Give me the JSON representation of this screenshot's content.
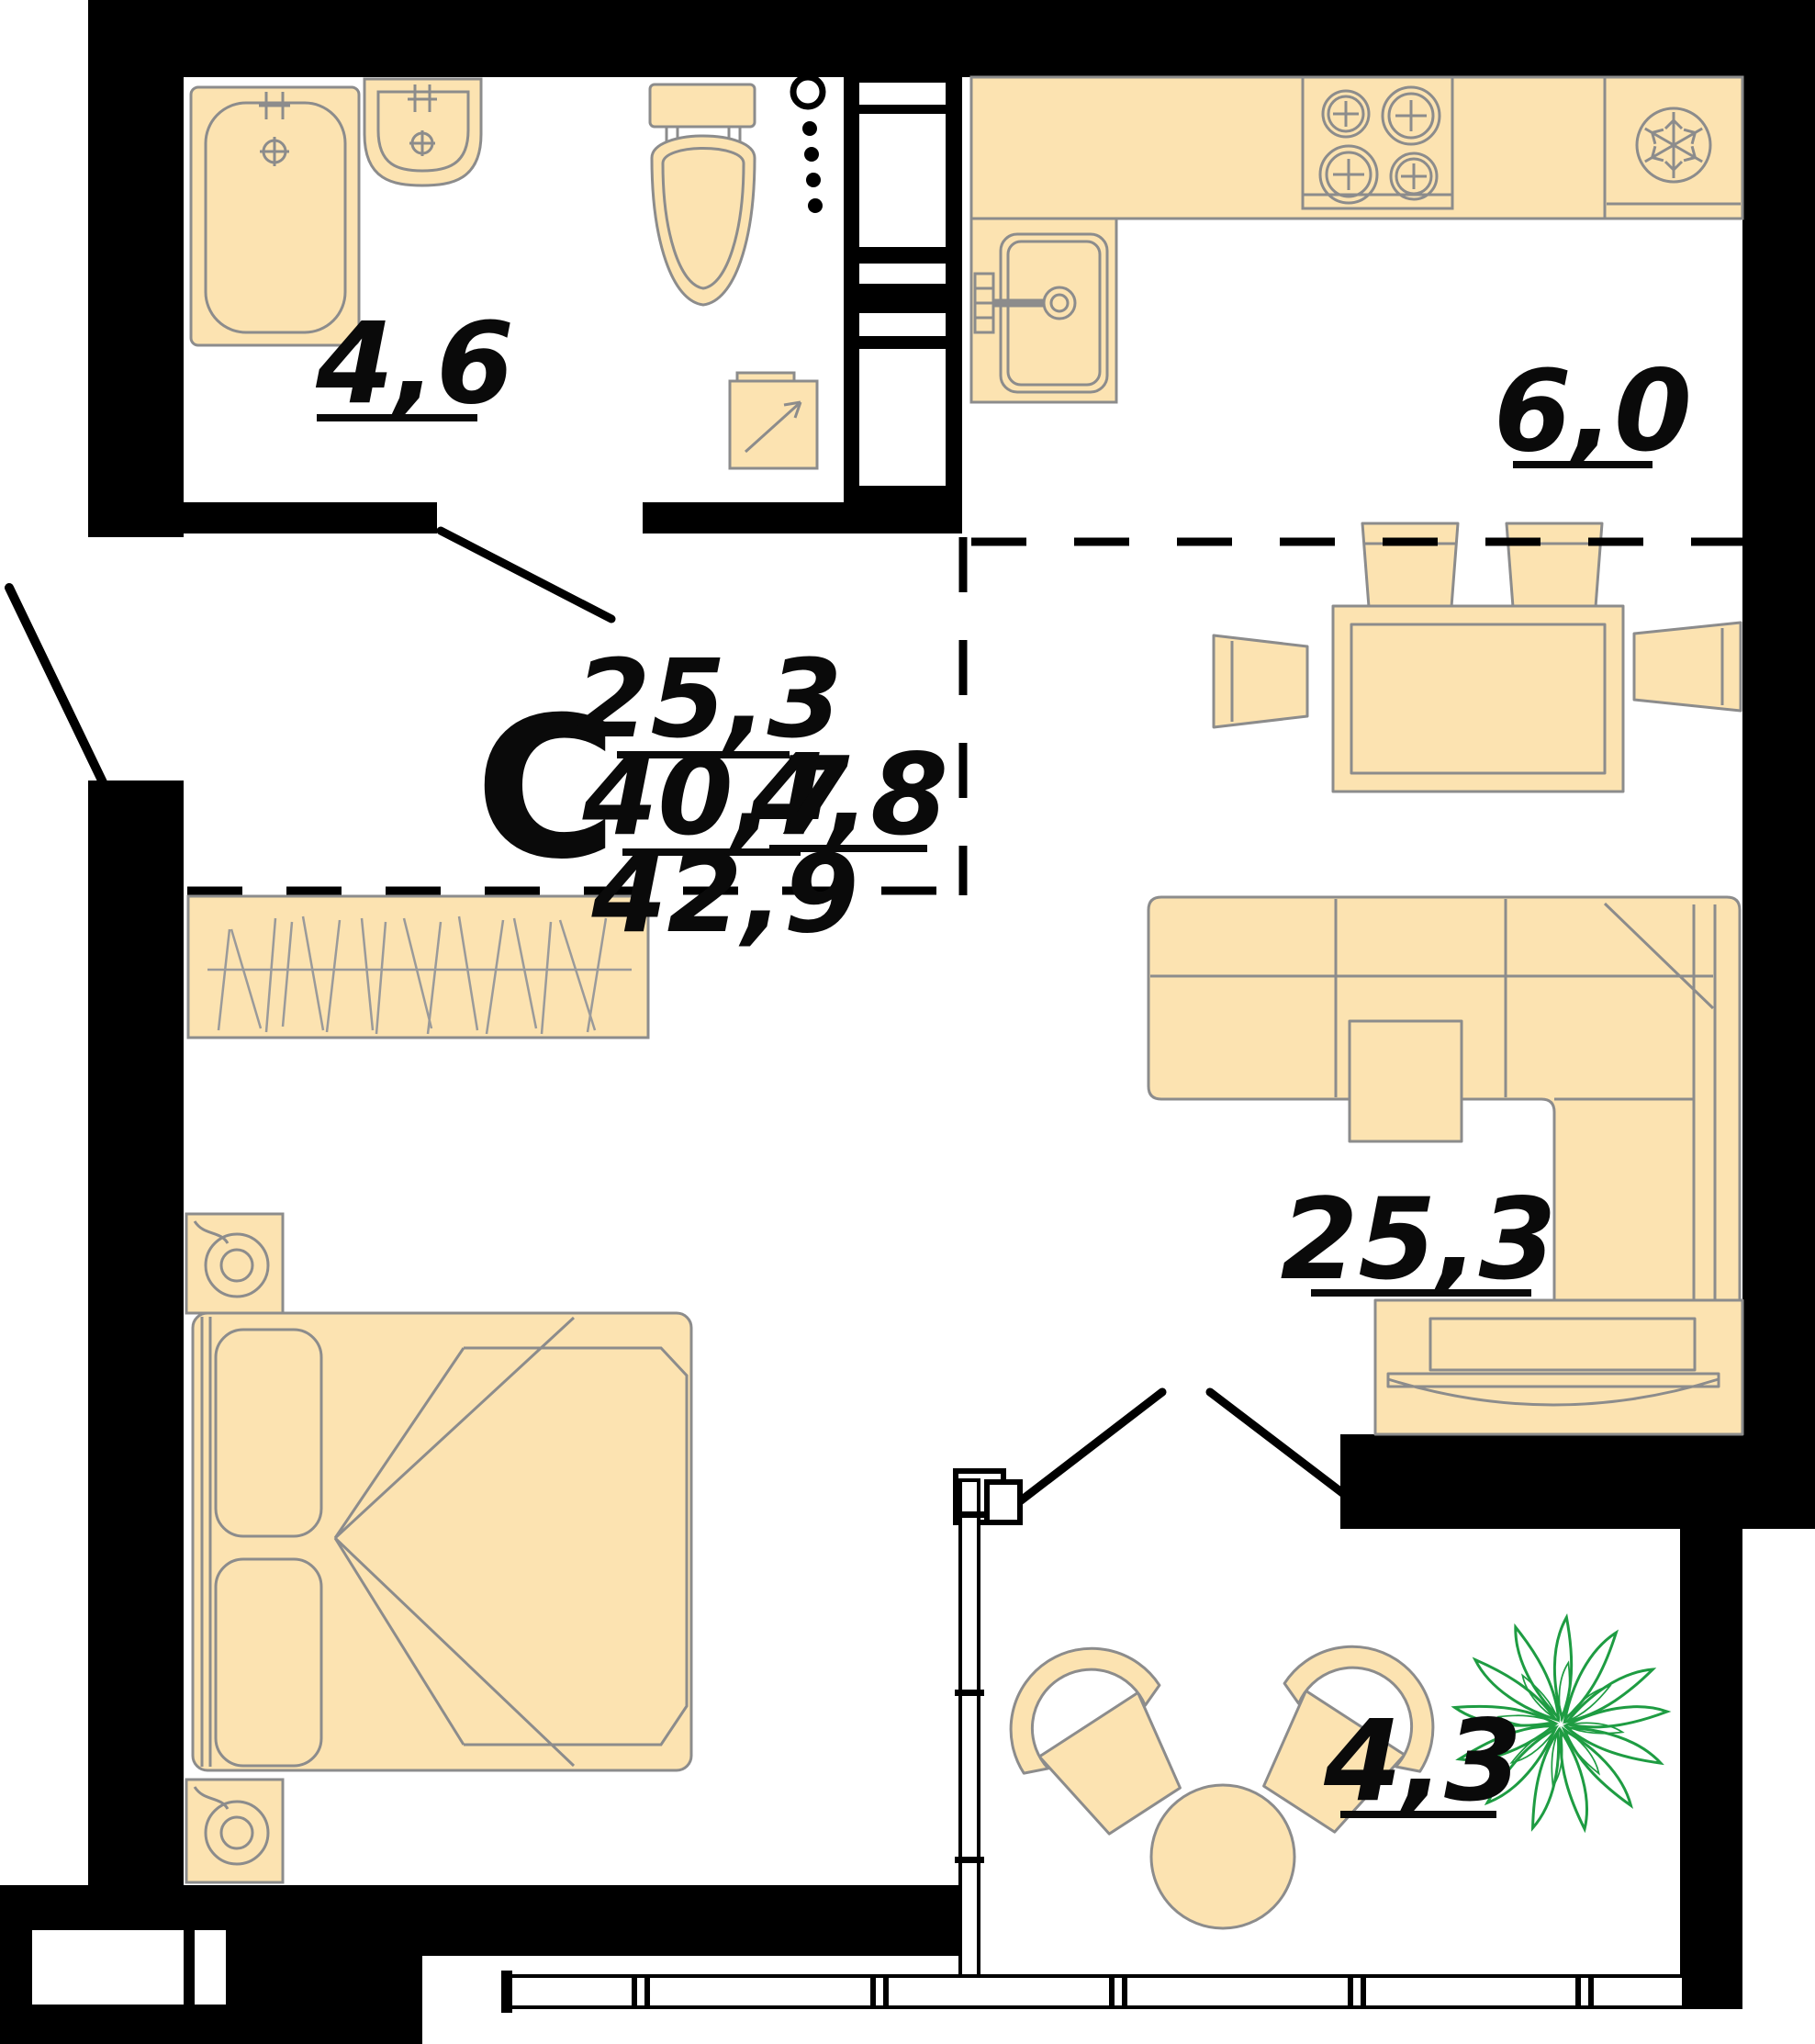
{
  "plan": {
    "title": "studio-apartment-floor-plan",
    "rooms": [
      {
        "id": "bathroom",
        "area_label": "4,6"
      },
      {
        "id": "kitchen",
        "area_label": "6,0"
      },
      {
        "id": "hall",
        "area_label": "4,8"
      },
      {
        "id": "living-room",
        "area_label": "25,3"
      },
      {
        "id": "balcony",
        "area_label": "4,3"
      }
    ],
    "summary": {
      "type_letter": "С",
      "room_area": "25,3",
      "living_area": "40,7",
      "total_area": "42,9"
    },
    "colors": {
      "wall": "#000000",
      "furniture_fill": "#FCE3B1",
      "furniture_outline": "#8C8C8C",
      "plant": "#1E9C42",
      "background": "#FFFFFF"
    }
  }
}
